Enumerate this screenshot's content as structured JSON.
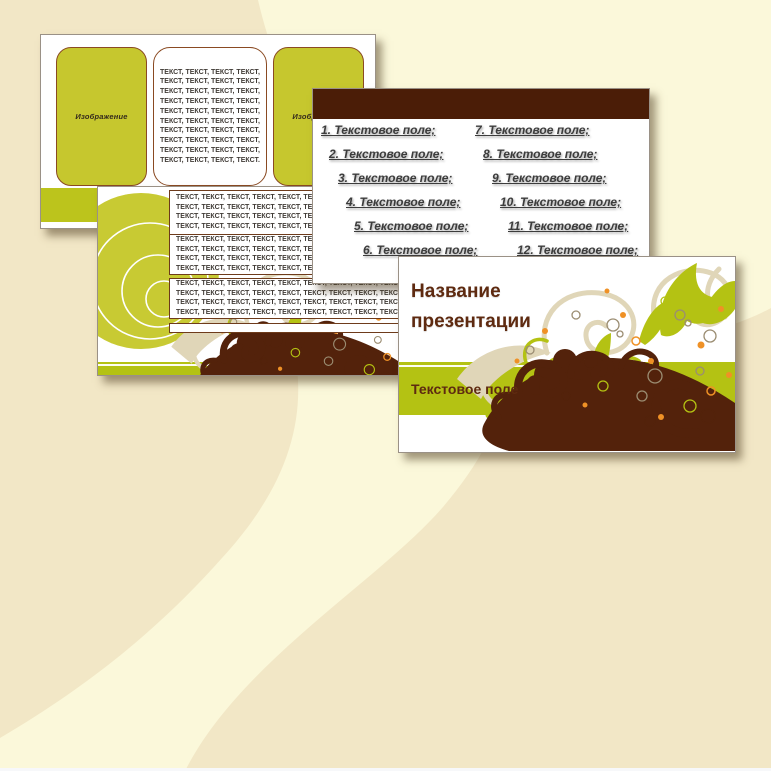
{
  "title_slide": {
    "title": "Название презентации",
    "subtitle": "Текстовое поле"
  },
  "list_slide": {
    "left_items": [
      "1. Текстовое поле;",
      "2. Текстовое поле;",
      "3. Текстовое поле;",
      "4. Текстовое поле;",
      "5. Текстовое поле;",
      "6. Текстовое поле;"
    ],
    "right_items": [
      "7. Текстовое поле;",
      "8. Текстовое поле;",
      "9. Текстовое поле;",
      "10. Текстовое поле;",
      "11. Текстовое поле;",
      "12. Текстовое поле;"
    ]
  },
  "layout_slide": {
    "image_label_left": "Изображение",
    "image_label_right": "Изображение",
    "text_lines": [
      "ТЕКСТ, ТЕКСТ, ТЕКСТ, ТЕКСТ,",
      "ТЕКСТ, ТЕКСТ, ТЕКСТ, ТЕКСТ,",
      "ТЕКСТ, ТЕКСТ, ТЕКСТ, ТЕКСТ,",
      "ТЕКСТ, ТЕКСТ, ТЕКСТ, ТЕКСТ,",
      "ТЕКСТ, ТЕКСТ, ТЕКСТ, ТЕКСТ,",
      "ТЕКСТ, ТЕКСТ, ТЕКСТ, ТЕКСТ,",
      "ТЕКСТ, ТЕКСТ, ТЕКСТ, ТЕКСТ,",
      "ТЕКСТ, ТЕКСТ, ТЕКСТ, ТЕКСТ,",
      "ТЕКСТ, ТЕКСТ, ТЕКСТ, ТЕКСТ,",
      "ТЕКСТ, ТЕКСТ, ТЕКСТ, ТЕКСТ."
    ]
  },
  "rows_slide": {
    "box1_lines": [
      "ТЕКСТ, ТЕКСТ, ТЕКСТ, ТЕКСТ, ТЕКСТ, ТЕКСТ, ТЕКСТ, ТЕКСТ, ТЕКСТ, ТЕКСТ, ТЕКСТ, ТЕКСТ,",
      "ТЕКСТ, ТЕКСТ, ТЕКСТ, ТЕКСТ, ТЕКСТ, ТЕКСТ, ТЕКСТ, ТЕКСТ, ТЕКСТ, ТЕКСТ, ТЕКСТ, ТЕКСТ,",
      "ТЕКСТ, ТЕКСТ, ТЕКСТ, ТЕКСТ, ТЕКСТ, ТЕКСТ, ТЕКСТ, ТЕКСТ, ТЕКСТ, ТЕКСТ, ТЕКСТ, ТЕКСТ,",
      "ТЕКСТ, ТЕКСТ, ТЕКСТ, ТЕКСТ, ТЕКСТ, ТЕКСТ, ТЕКСТ, ТЕКСТ, ТЕКСТ, ТЕКСТ, ТЕКСТ, ТЕКСТ,"
    ],
    "box2_lines": [
      "ТЕКСТ, ТЕКСТ, ТЕКСТ, ТЕКСТ, ТЕКСТ, ТЕКСТ, ТЕКСТ, ТЕКСТ, ТЕКСТ, ТЕКСТ, ТЕКСТ, ТЕКСТ,",
      "ТЕКСТ, ТЕКСТ, ТЕКСТ, ТЕКСТ, ТЕКСТ, ТЕКСТ, ТЕКСТ, ТЕКСТ, ТЕКСТ, ТЕКСТ, ТЕКСТ, ТЕКСТ,",
      "ТЕКСТ, ТЕКСТ, ТЕКСТ, ТЕКСТ, ТЕКСТ, ТЕКСТ, ТЕКСТ, ТЕКСТ, ТЕКСТ, ТЕКСТ, ТЕКСТ, ТЕКСТ,",
      "ТЕКСТ, ТЕКСТ, ТЕКСТ, ТЕКСТ, ТЕКСТ, ТЕКСТ, ТЕКСТ, ТЕКСТ, ТЕКСТ, ТЕКСТ, ТЕКСТ, ТЕКСТ,"
    ],
    "box3_lines": [
      "ТЕКСТ, ТЕКСТ, ТЕКСТ, ТЕКСТ, ТЕКСТ, ТЕКСТ, ТЕКСТ, ТЕКСТ, ТЕКСТ, ТЕКСТ, ТЕКСТ, ТЕКСТ,",
      "ТЕКСТ, ТЕКСТ, ТЕКСТ, ТЕКСТ, ТЕКСТ, ТЕКСТ, ТЕКСТ, ТЕКСТ, ТЕКСТ, ТЕКСТ, ТЕКСТ, ТЕКСТ,",
      "ТЕКСТ, ТЕКСТ, ТЕКСТ, ТЕКСТ, ТЕКСТ, ТЕКСТ, ТЕКСТ, ТЕКСТ, ТЕКСТ, ТЕКСТ, ТЕКСТ, ТЕКСТ,",
      "ТЕКСТ, ТЕКСТ, ТЕКСТ, ТЕКСТ, ТЕКСТ, ТЕКСТ, ТЕКСТ, ТЕКСТ, ТЕКСТ, ТЕКСТ, ТЕКСТ, ТЕКСТ,"
    ]
  },
  "colors": {
    "olive_band": "#b4c213",
    "olive_box": "#c6c72e",
    "olive_circle": "#c8ca33",
    "brown_swirl": "#53220b",
    "header_brown": "#4b1d07",
    "title_text_brown": "#5e2a10",
    "body_text": "#3c3c3c",
    "background_cream": "#f2e7c6",
    "background_light": "#fbf8da",
    "orange_accent": "#ef9126",
    "tan_accent": "#e0d6b8"
  }
}
